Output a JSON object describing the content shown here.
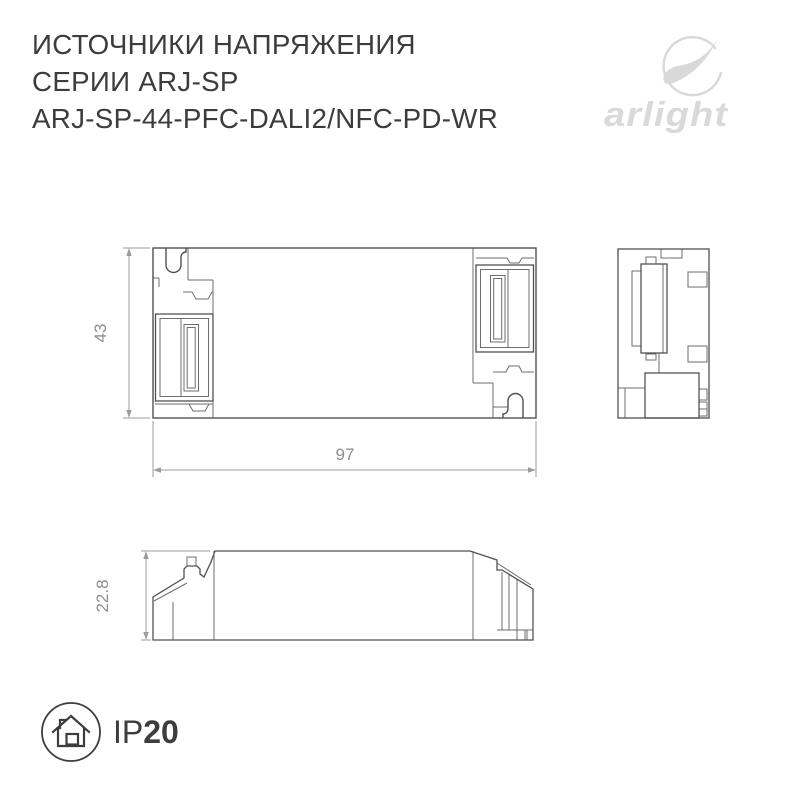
{
  "header": {
    "line1": "ИСТОЧНИКИ НАПРЯЖЕНИЯ",
    "line2": "СЕРИИ ARJ-SP",
    "line3": "ARJ-SP-44-PFC-DALI2/NFC-PD-WR"
  },
  "logo": {
    "text": "arlight"
  },
  "drawing": {
    "dimensions": {
      "height_mm": "43",
      "width_mm": "97",
      "depth_mm": "22.8"
    }
  },
  "badge": {
    "ip_prefix": "IP",
    "ip_value": "20"
  },
  "colors": {
    "title_text": "#3c3c3c",
    "logo_gray": "#d9d9d9",
    "outline_dark": "#515151",
    "outline_thin": "#6e6e6e",
    "dimension_line": "#9b9b9b",
    "dimension_text": "#8e8e8e",
    "ip_text": "#3d3d3d",
    "background": "#ffffff"
  }
}
